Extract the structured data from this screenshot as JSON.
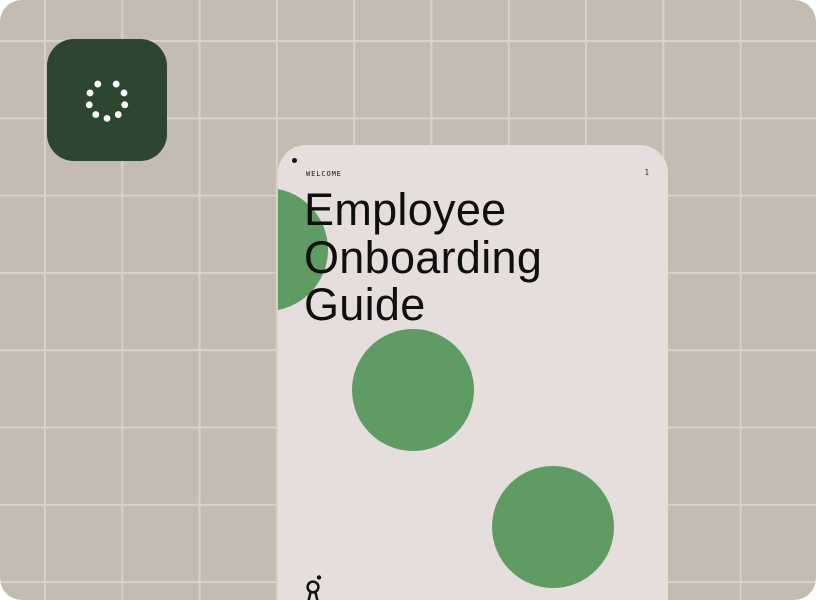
{
  "canvas": {
    "background_color": "#c4bbb1",
    "grid_line_color": "#d8d2c9"
  },
  "logo_tile": {
    "background_color": "#2c4630",
    "icon": "dotted-loader-icon",
    "icon_color": "#ffffff"
  },
  "card": {
    "background_color": "#e5dedc",
    "accent_circle_color": "#5f9c64",
    "eyebrow_label": "WELCOME",
    "page_number": "1",
    "title": "Employee\nOnboarding\nGuide",
    "title_color": "#0f0f0f",
    "footer_icon": "person-logo-icon",
    "footer_icon_color": "#141414"
  }
}
